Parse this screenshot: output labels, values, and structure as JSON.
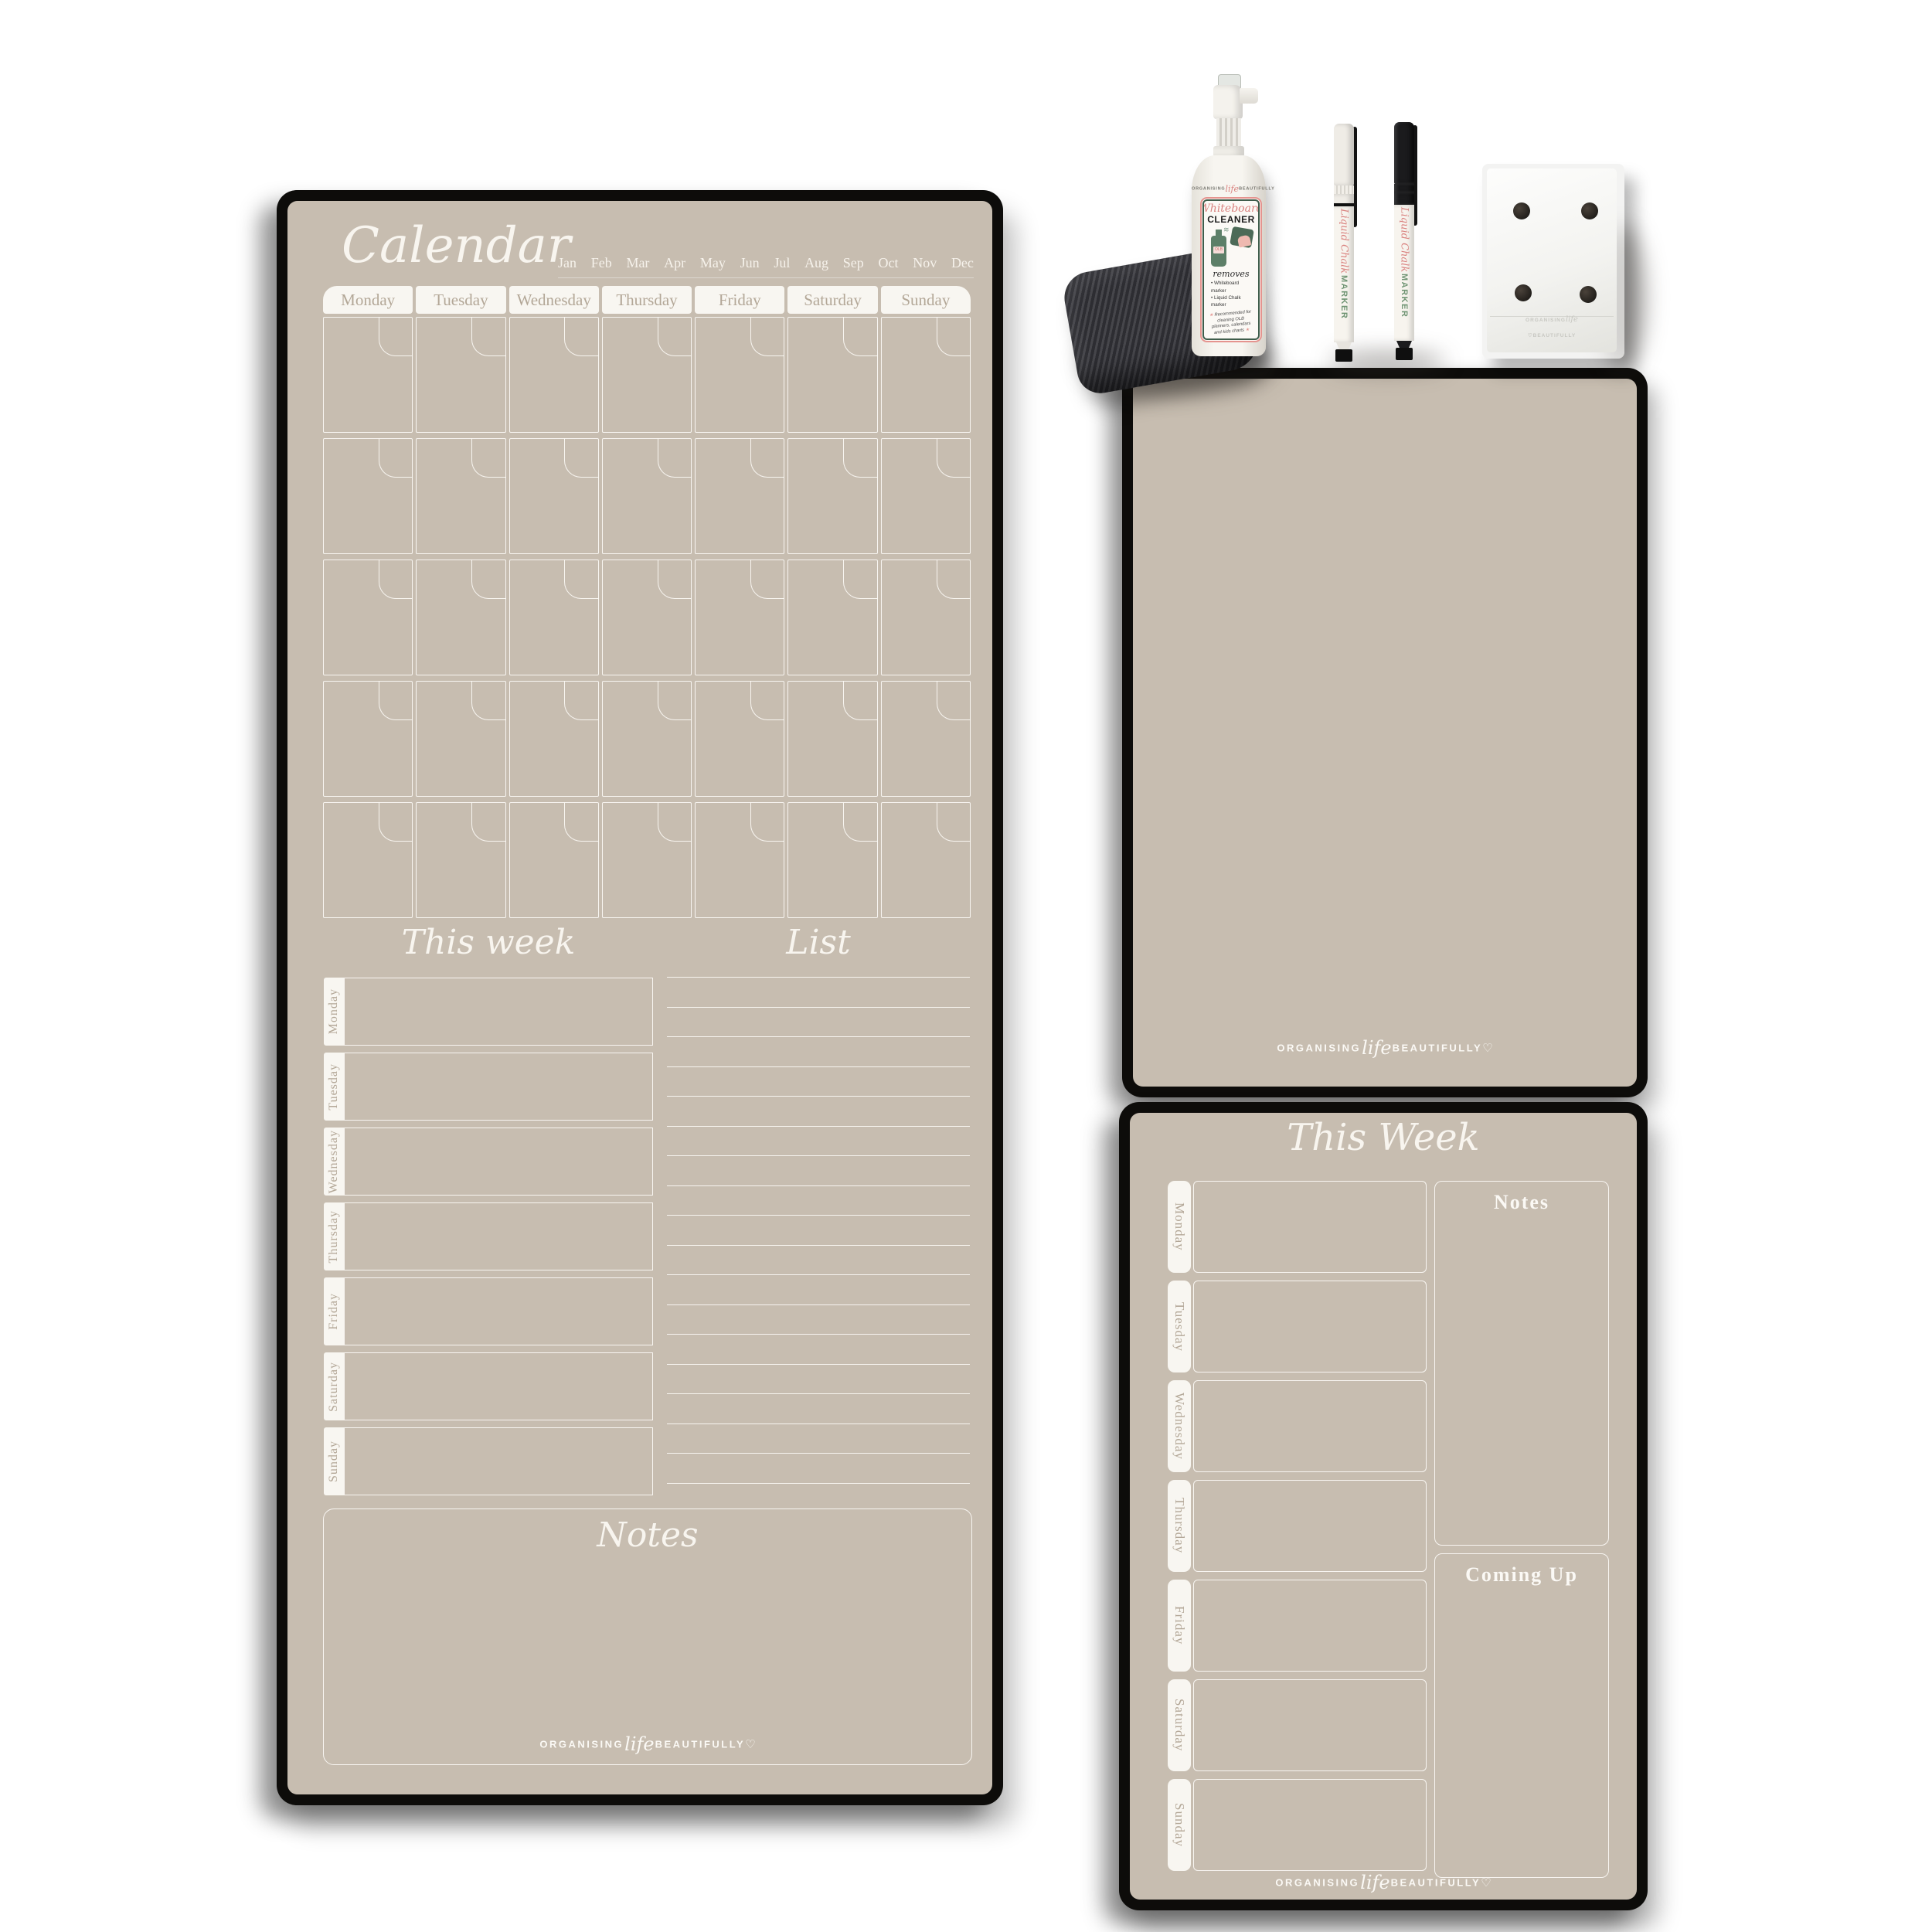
{
  "branding": {
    "caps1": "ORGANISING",
    "script": "life",
    "caps2": "BEAUTIFULLY",
    "heart": "♡"
  },
  "calendar_board": {
    "title": "Calendar",
    "months": [
      "Jan",
      "Feb",
      "Mar",
      "Apr",
      "May",
      "Jun",
      "Jul",
      "Aug",
      "Sep",
      "Oct",
      "Nov",
      "Dec"
    ],
    "day_headers": [
      "Monday",
      "Tuesday",
      "Wednesday",
      "Thursday",
      "Friday",
      "Saturday",
      "Sunday"
    ],
    "grid": {
      "rows": 5,
      "columns": 7,
      "cell_count": 35
    },
    "this_week": {
      "title": "This week",
      "days": [
        "Monday",
        "Tuesday",
        "Wednesday",
        "Thursday",
        "Friday",
        "Saturday",
        "Sunday"
      ]
    },
    "list": {
      "title": "List",
      "line_count": 18
    },
    "notes": {
      "title": "Notes"
    }
  },
  "week_board": {
    "title": "This Week",
    "days": [
      "Monday",
      "Tuesday",
      "Wednesday",
      "Thursday",
      "Friday",
      "Saturday",
      "Sunday"
    ],
    "notes_label": "Notes",
    "coming_up_label": "Coming Up"
  },
  "accessories": {
    "cleaner_bottle": {
      "title_script": "Whiteboard",
      "title_caps": "CLEANER",
      "removes": "removes",
      "bullets": [
        "• Whiteboard marker",
        "• Liquid Chalk marker"
      ],
      "footnote": "Recommended for cleaning OLB planners, calendars and kids charts",
      "bottle_tag": "OLB",
      "star": "★",
      "spray_glyph": "≋"
    },
    "markers": [
      {
        "body": "white",
        "label_script": "Liquid Chalk",
        "label_caps": "MARKER"
      },
      {
        "body": "black",
        "label_script": "Liquid Chalk",
        "label_caps": "MARKER"
      }
    ],
    "eraser": {
      "magnet_count": 4
    }
  },
  "colors": {
    "board_surface": "#c7bdb0",
    "board_frame": "#0d0c0a",
    "line_white": "#faf8f3",
    "tab_fill": "#f8f6f1",
    "header_text": "#b3a797",
    "label_pink": "#d9827f",
    "label_green": "#6f9473",
    "label_border_green": "#3f5d4b",
    "label_border_pink": "#e5948f"
  }
}
